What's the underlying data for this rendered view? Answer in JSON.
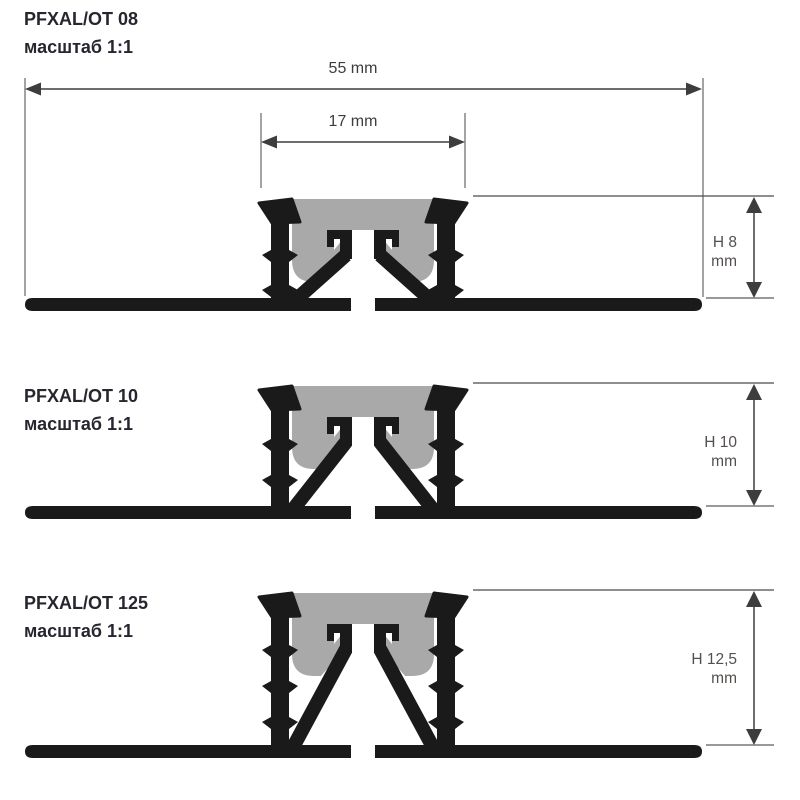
{
  "drawing": {
    "profile_color": "#1a1a1a",
    "insert_color": "#a9a9a9",
    "line_color": "#3d3d3d",
    "ext_line_color": "#666666",
    "ref_line_color": "#999999",
    "title_color": "#26262f",
    "h_label_color": "#54504d"
  },
  "dimensions": {
    "total_width_label": "55 mm",
    "inner_width_label": "17 mm"
  },
  "profiles": [
    {
      "name": "PFXAL/OT 08",
      "scale": "масштаб 1:1",
      "height_value": "H 8",
      "height_unit": "mm"
    },
    {
      "name": "PFXAL/OT 10",
      "scale": "масштаб 1:1",
      "height_value": "H 10",
      "height_unit": "mm"
    },
    {
      "name": "PFXAL/OT 125",
      "scale": "масштаб 1:1",
      "height_value": "H 12,5",
      "height_unit": "mm"
    }
  ]
}
